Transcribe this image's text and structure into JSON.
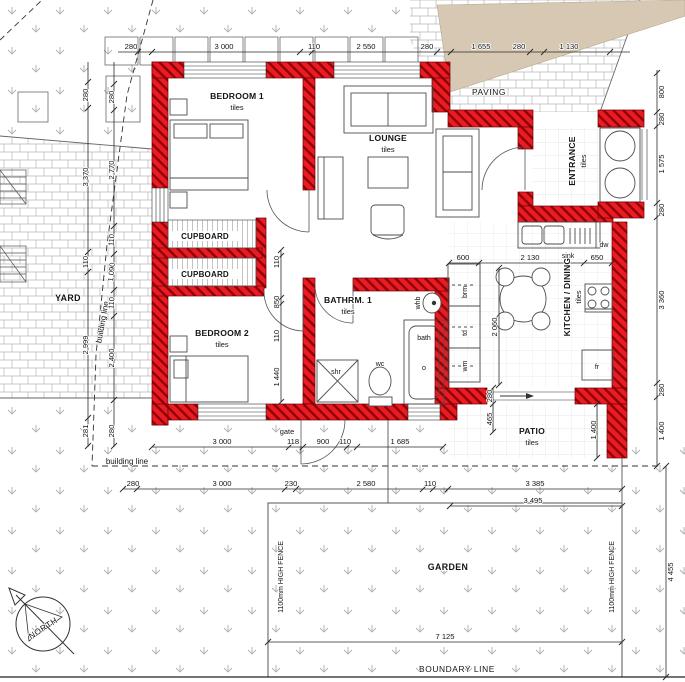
{
  "rooms": {
    "bedroom1": {
      "name": "BEDROOM 1",
      "finish": "tiles"
    },
    "bedroom2": {
      "name": "BEDROOM 2",
      "finish": "tiles"
    },
    "lounge": {
      "name": "LOUNGE",
      "finish": "tiles"
    },
    "entrance": {
      "name": "ENTRANCE",
      "finish": "tiles"
    },
    "kitchen_dining": {
      "name": "KITCHEN / DINING",
      "finish": "tiles"
    },
    "bathroom1": {
      "name": "BATHRM. 1",
      "finish": "tiles"
    },
    "patio": {
      "name": "PATIO",
      "finish": "tiles"
    }
  },
  "cupboards": [
    "CUPBOARD",
    "CUPBOARD"
  ],
  "site": {
    "yard": "YARD",
    "paving": "PAVING",
    "garden": "GARDEN",
    "gate": "gate",
    "boundary_line": "BOUNDARY LINE",
    "building_line": "building line",
    "fence": "1100mm HIGH FENCE"
  },
  "compass": {
    "north": "NORTH"
  },
  "fixtures": {
    "sink": "sink",
    "dw": "dw",
    "wc": "wc",
    "whb": "whb",
    "bath": "bath",
    "bath_o": "o",
    "shr": "shr",
    "brm": "brm",
    "td": "td",
    "wm": "wm",
    "fr": "fr"
  },
  "dims": {
    "top": [
      "280",
      "3 000",
      "110",
      "2 550",
      "280",
      "1 655",
      "280",
      "1 130"
    ],
    "right": [
      "800",
      "280",
      "1 575",
      "280",
      "3 360",
      "280",
      "1 400"
    ],
    "right_total": "4 455",
    "left_outer": [
      "280",
      "3 370",
      "110",
      "2 999",
      "281"
    ],
    "left_inner": [
      "280",
      "2 770",
      "110",
      "1 090",
      "110",
      "2 400",
      "280"
    ],
    "row1": [
      "3 000",
      "118",
      "900",
      "110",
      "1 685"
    ],
    "row2": [
      "280",
      "3 000",
      "230",
      "2 580",
      "110",
      "3 385"
    ],
    "row3": "3 495",
    "garden_width": "7 125",
    "kitchen_top": [
      "600",
      "2 130",
      "650"
    ],
    "kitchen_depth": "2 060",
    "bed2_chain": [
      "110",
      "850",
      "110",
      "1 440"
    ],
    "patio_chain": [
      "280",
      "465"
    ],
    "patio_width": "1 400"
  },
  "colors": {
    "wall_red": "#ea1c22",
    "paving_tan": "#d6c8b2"
  }
}
